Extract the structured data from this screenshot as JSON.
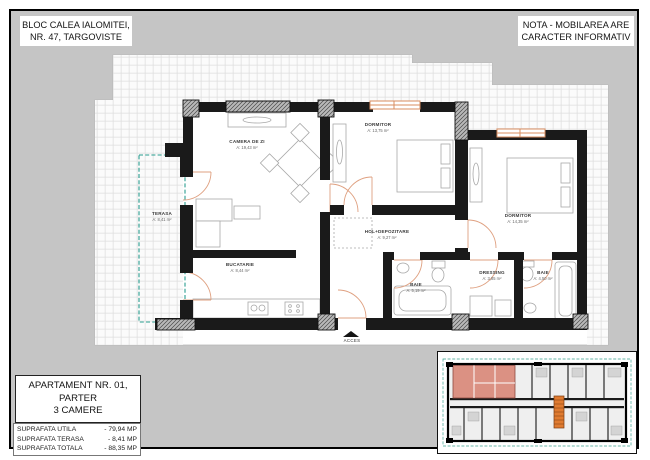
{
  "header": {
    "left_note": {
      "line1": "BLOC CALEA IALOMITEI,",
      "line2": "NR. 47, TARGOVISTE"
    },
    "right_note": {
      "line1": "NOTA - MOBILAREA ARE",
      "line2": "CARACTER INFORMATIV"
    }
  },
  "plan": {
    "rooms": [
      {
        "name": "CAMERA DE ZI",
        "area": "A: 19,43 m²"
      },
      {
        "name": "DORMITOR",
        "area": "A: 13,75 m²"
      },
      {
        "name": "DORMITOR",
        "area": "A: 14,35 m²"
      },
      {
        "name": "TERASA",
        "area": "A: 8,41 m²"
      },
      {
        "name": "BUCATARIE",
        "area": "A: 8,44 m²"
      },
      {
        "name": "HOL+DEPOZITARE",
        "area": "A: 9,27 m²"
      },
      {
        "name": "BAIE",
        "area": "A: 5,19 m²"
      },
      {
        "name": "DRESSING",
        "area": "A: 3,85 m²"
      },
      {
        "name": "BAIE",
        "area": "A: 4,50 m²"
      }
    ],
    "entrance_label": "ACCES"
  },
  "info": {
    "title_line1": "APARTAMENT NR. 01,",
    "title_line2": "PARTER",
    "title_line3": "3 CAMERE",
    "areas": [
      {
        "label": "SUPRAFATA UTILA",
        "value": "-  79,94 MP"
      },
      {
        "label": "SUPRAFATA TERASA",
        "value": "-  8,41 MP"
      },
      {
        "label": "SUPRAFATA TOTALA",
        "value": "-  88,35 MP"
      }
    ]
  },
  "colors": {
    "canvas_bg": "#c5c5c5",
    "wall": "#1a1a1a",
    "door_arc": "#dfa080",
    "window_accent": "#d98c5f",
    "terrace_dash": "#2a9d8f",
    "mini_highlight": "#db9183",
    "mini_stair": "#e07b30"
  }
}
